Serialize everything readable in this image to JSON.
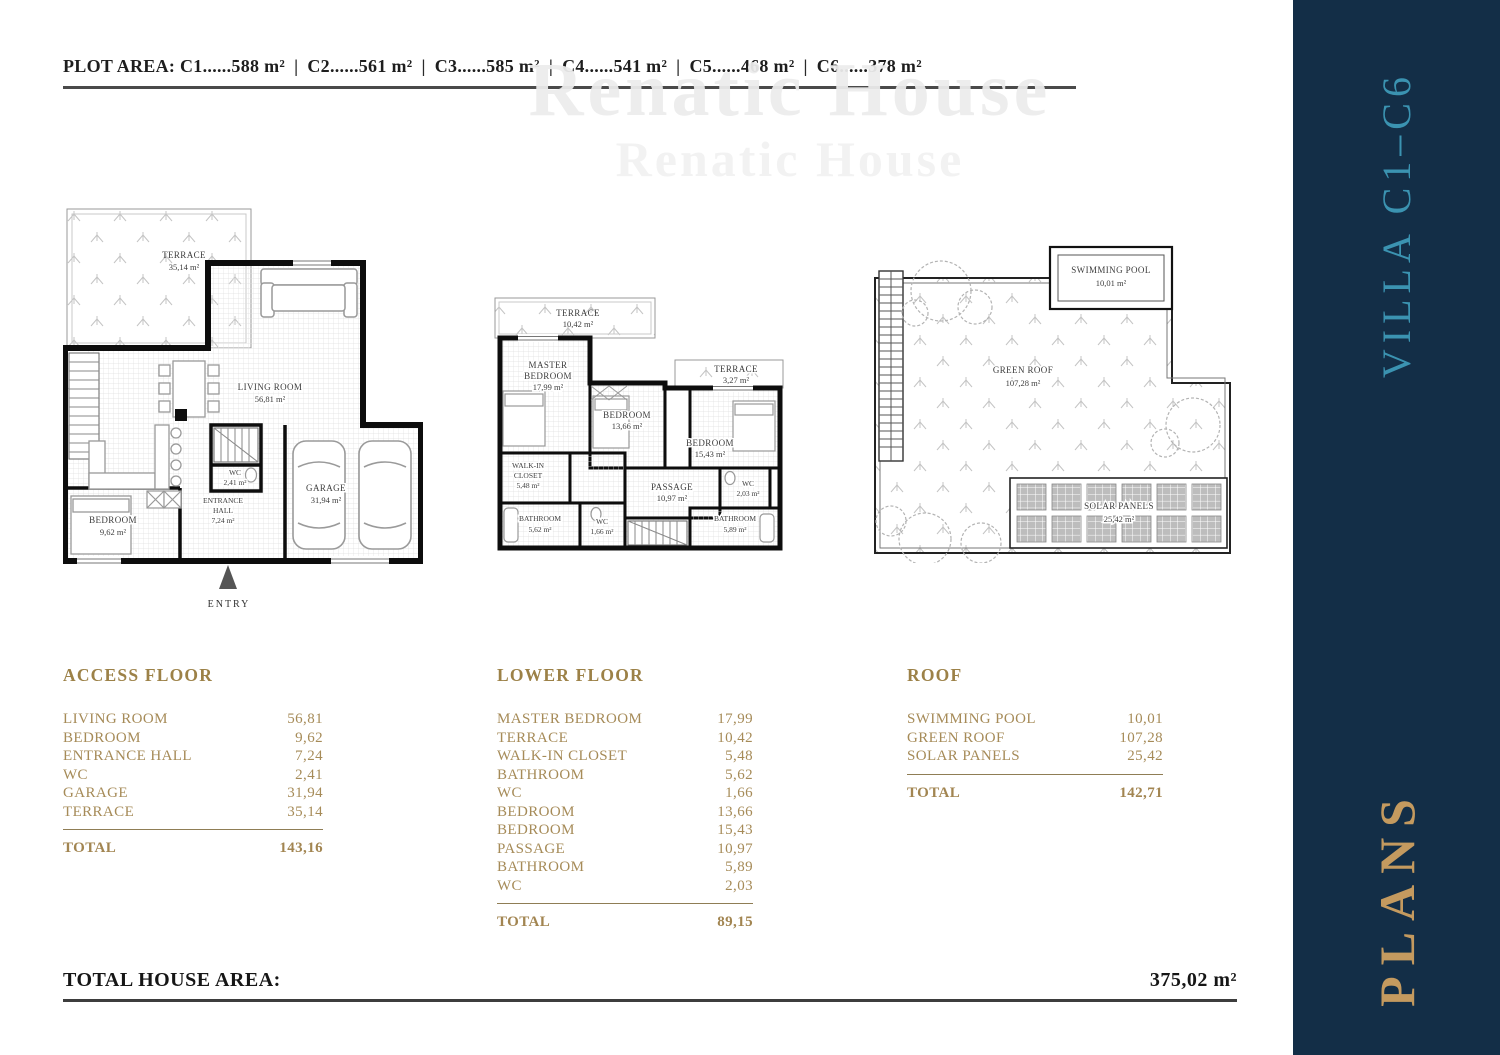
{
  "colors": {
    "gold_text": "#a68b58",
    "gold_title": "#9c8147",
    "sidebar_navy": "#132e47",
    "villa_teal": "#3b93b1",
    "plans_gold": "#c49a5f"
  },
  "header": {
    "label": "PLOT AREA:",
    "separator": "|",
    "segments": [
      "C1......588 m²",
      "C2......561 m²",
      "C3......585 m²",
      "C4......541 m²",
      "C5......468 m²",
      "C6......378 m²"
    ]
  },
  "watermark": {
    "line1": "Renatic House",
    "line2": "Renatic House"
  },
  "plans": {
    "access": {
      "entry_label": "ENTRY",
      "rooms": {
        "terrace": {
          "name": "TERRACE",
          "area": "35,14 m²"
        },
        "living": {
          "name": "LIVING ROOM",
          "area": "56,81 m²"
        },
        "bedroom": {
          "name": "BEDROOM",
          "area": "9,62 m²"
        },
        "entrance": {
          "line1": "ENTRANCE",
          "line2": "HALL",
          "area": "7,24 m²"
        },
        "wc": {
          "name": "WC",
          "area": "2,41 m²"
        },
        "garage": {
          "name": "GARAGE",
          "area": "31,94 m²"
        }
      }
    },
    "lower": {
      "rooms": {
        "terrace_top": {
          "name": "TERRACE",
          "area": "10,42 m²"
        },
        "master": {
          "line1": "MASTER",
          "line2": "BEDROOM",
          "area": "17,99 m²"
        },
        "bedroom_mid": {
          "name": "BEDROOM",
          "area": "13,66 m²"
        },
        "terrace_right": {
          "name": "TERRACE",
          "area": "3,27 m²"
        },
        "bedroom_right": {
          "name": "BEDROOM",
          "area": "15,43 m²"
        },
        "closet": {
          "line1": "WALK-IN",
          "line2": "CLOSET",
          "area": "5,48 m²"
        },
        "passage": {
          "name": "PASSAGE",
          "area": "10,97 m²"
        },
        "wc_right": {
          "name": "WC",
          "area": "2,03 m²"
        },
        "bathroom_left": {
          "name": "BATHROOM",
          "area": "5,62 m²"
        },
        "wc_mid": {
          "name": "WC",
          "area": "1,66 m²"
        },
        "bathroom_right": {
          "name": "BATHROOM",
          "area": "5,89 m²"
        }
      }
    },
    "roof": {
      "rooms": {
        "pool": {
          "name": "SWIMMING POOL",
          "area": "10,01 m²"
        },
        "green": {
          "name": "GREEN ROOF",
          "area": "107,28 m²"
        },
        "solar": {
          "name": "SOLAR PANELS",
          "area": "25,42 m²"
        }
      }
    }
  },
  "tables": {
    "access": {
      "title": "ACCESS FLOOR",
      "rows": [
        {
          "label": "LIVING ROOM",
          "value": "56,81"
        },
        {
          "label": "BEDROOM",
          "value": "9,62"
        },
        {
          "label": "ENTRANCE HALL",
          "value": "7,24"
        },
        {
          "label": "WC",
          "value": "2,41"
        },
        {
          "label": "GARAGE",
          "value": "31,94"
        },
        {
          "label": "TERRACE",
          "value": "35,14"
        }
      ],
      "total_label": "TOTAL",
      "total_value": "143,16"
    },
    "lower": {
      "title": "LOWER FLOOR",
      "rows": [
        {
          "label": "MASTER BEDROOM",
          "value": "17,99"
        },
        {
          "label": "TERRACE",
          "value": "10,42"
        },
        {
          "label": "WALK-IN CLOSET",
          "value": "5,48"
        },
        {
          "label": "BATHROOM",
          "value": "5,62"
        },
        {
          "label": "WC",
          "value": "1,66"
        },
        {
          "label": "BEDROOM",
          "value": "13,66"
        },
        {
          "label": "BEDROOM",
          "value": "15,43"
        },
        {
          "label": "PASSAGE",
          "value": "10,97"
        },
        {
          "label": "BATHROOM",
          "value": "5,89"
        },
        {
          "label": "WC",
          "value": "2,03"
        }
      ],
      "total_label": "TOTAL",
      "total_value": "89,15"
    },
    "roof": {
      "title": "ROOF",
      "rows": [
        {
          "label": "SWIMMING POOL",
          "value": "10,01"
        },
        {
          "label": "GREEN ROOF",
          "value": "107,28"
        },
        {
          "label": "SOLAR PANELS",
          "value": "25,42"
        }
      ],
      "total_label": "TOTAL",
      "total_value": "142,71"
    }
  },
  "footer": {
    "label": "TOTAL HOUSE AREA:",
    "value": "375,02 m²"
  },
  "sidebar": {
    "villa_label": "VILLA C1–C6",
    "plans_label": "PLANS"
  }
}
